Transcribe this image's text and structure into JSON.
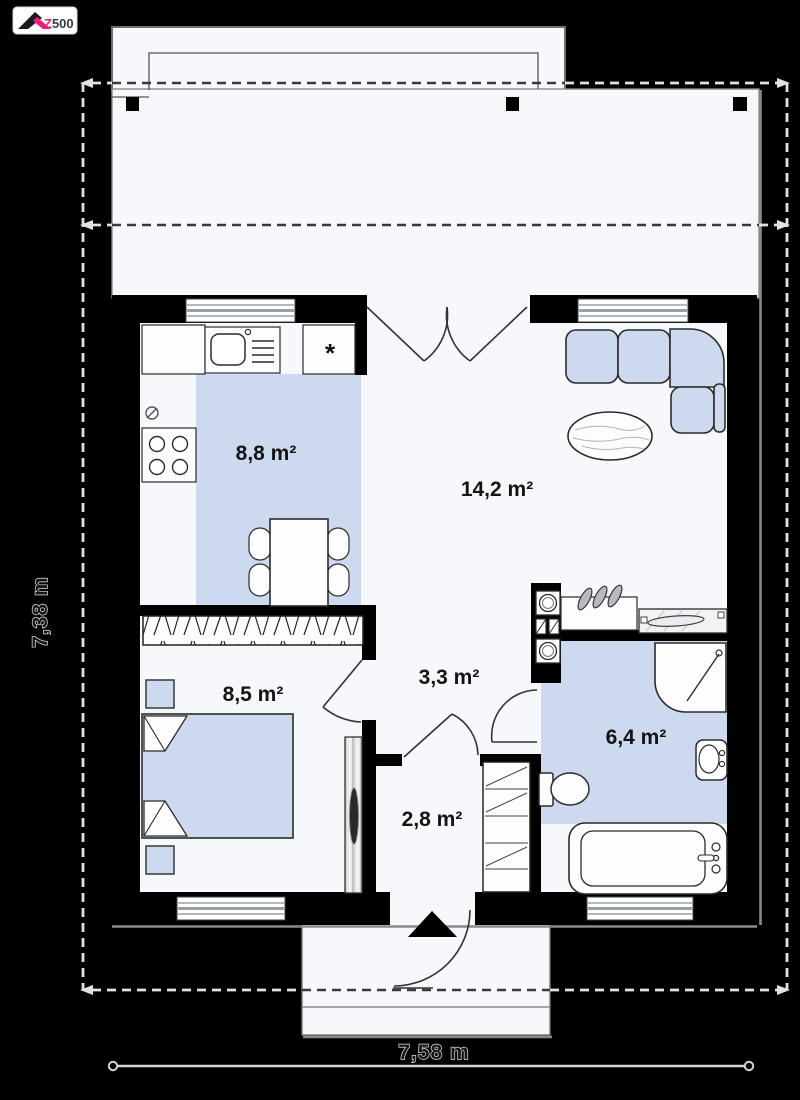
{
  "logo": {
    "z": "Z",
    "rest": "500"
  },
  "plan": {
    "rooms": {
      "kitchen": {
        "area": "8,8 m²"
      },
      "living": {
        "area": "14,2 m²"
      },
      "bedroom": {
        "area": "8,5 m²"
      },
      "hall": {
        "area": "3,3 m²"
      },
      "vestibule": {
        "area": "2,8 m²"
      },
      "bathroom": {
        "area": "6,4 m²"
      }
    },
    "dimensions": {
      "width": "7,58 m",
      "height": "7,38 m"
    },
    "symbols": {
      "pantry_mark": "*"
    },
    "colors": {
      "background": "#000000",
      "floor": "#f7f8fb",
      "furniture_fill": "#ccd9ee",
      "wall": "#000000",
      "logo_pink": "#ec1d7e"
    }
  }
}
